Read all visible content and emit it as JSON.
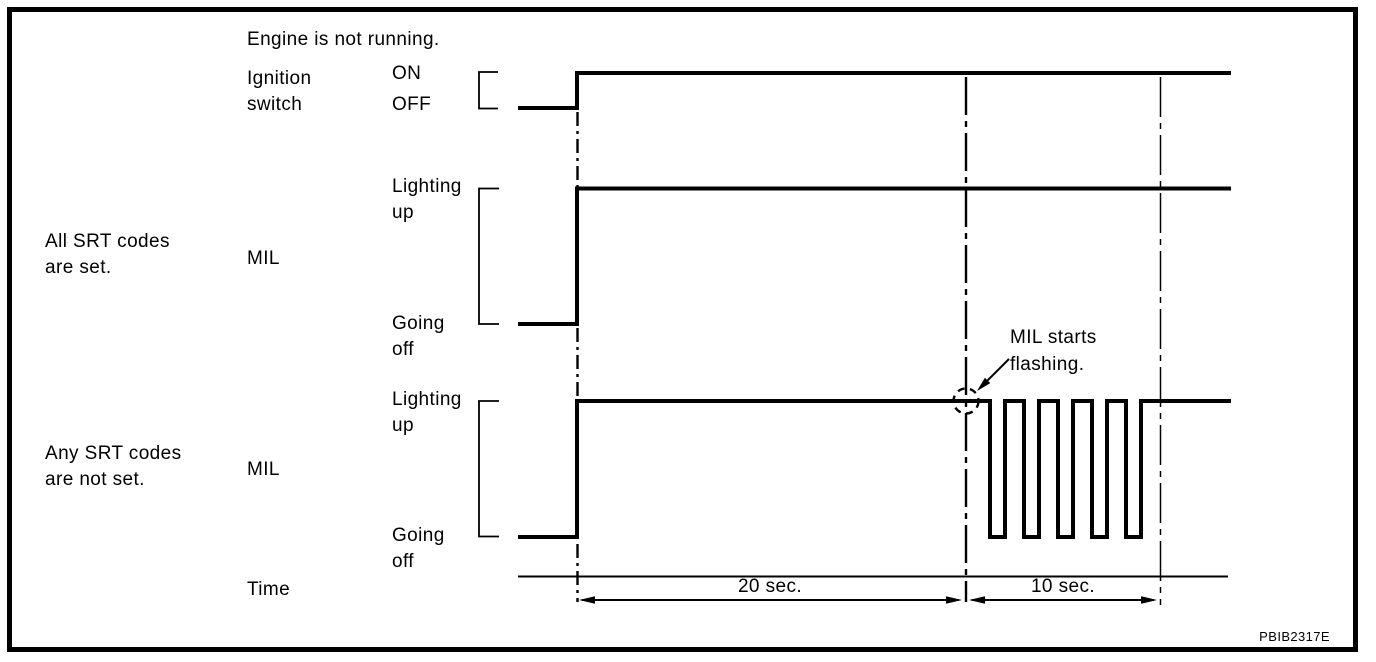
{
  "palette": {
    "ink": "#000000",
    "paper": "#ffffff"
  },
  "header_note": "Engine is not running.",
  "figure_code": "PBIB2317E",
  "row_groups": {
    "all_set": "All SRT codes\nare set.",
    "any_not_set": "Any SRT codes\nare not set."
  },
  "signals": {
    "ignition": {
      "label": "Ignition\nswitch",
      "high_state": "ON",
      "low_state": "OFF"
    },
    "mil_all_set": {
      "label": "MIL",
      "high_state": "Lighting\nup",
      "low_state": "Going\noff"
    },
    "mil_any_not_set": {
      "label": "MIL",
      "high_state": "Lighting\nup",
      "low_state": "Going\noff"
    }
  },
  "annotation": {
    "label": "MIL starts\nflashing."
  },
  "time_axis": {
    "label": "Time",
    "spans": [
      {
        "duration": "20 sec."
      },
      {
        "duration": "10 sec."
      }
    ]
  },
  "chart_data": {
    "type": "timing-diagram",
    "title": "Engine is not running.",
    "x_unit": "seconds",
    "signals": [
      {
        "name": "Ignition switch",
        "levels": [
          "ON",
          "OFF"
        ],
        "segments": [
          {
            "state": "OFF",
            "to_t": 0
          },
          {
            "state": "ON",
            "from_t": 0
          }
        ]
      },
      {
        "name": "MIL (All SRT codes are set.)",
        "levels": [
          "Lighting up",
          "Going off"
        ],
        "segments": [
          {
            "state": "Going off",
            "to_t": 0
          },
          {
            "state": "Lighting up",
            "from_t": 0
          }
        ]
      },
      {
        "name": "MIL (Any SRT codes are not set.)",
        "levels": [
          "Lighting up",
          "Going off"
        ],
        "segments": [
          {
            "state": "Going off",
            "to_t": 0
          },
          {
            "state": "Lighting up",
            "from_t": 0,
            "to_t": 20
          },
          {
            "state": "Flashing",
            "from_t": 20,
            "to_t": 30,
            "pulses": 5
          },
          {
            "state": "Lighting up",
            "from_t": 30
          }
        ]
      }
    ],
    "markers": [
      {
        "t": 20,
        "label": "MIL starts flashing."
      }
    ],
    "intervals": [
      {
        "label": "20 sec.",
        "from_t": 0,
        "to_t": 20
      },
      {
        "label": "10 sec.",
        "from_t": 20,
        "to_t": 30
      }
    ]
  }
}
